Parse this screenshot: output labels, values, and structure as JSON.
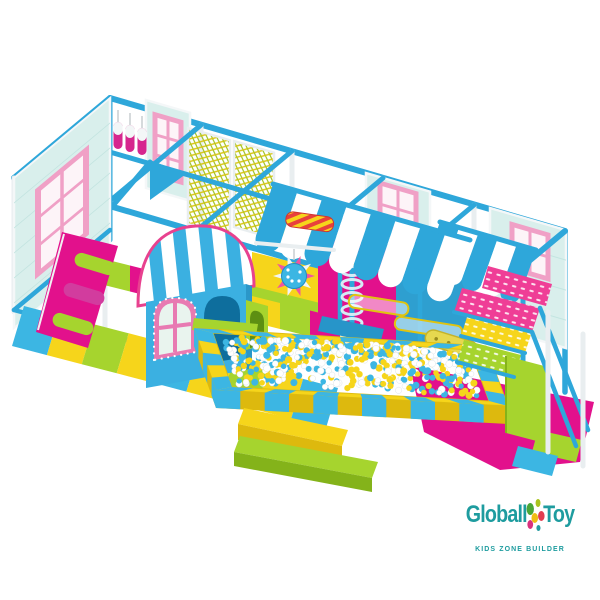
{
  "page": {
    "background": "#ffffff"
  },
  "logo": {
    "brand_first": "Globall",
    "brand_second": "Toy",
    "tagline": "KIDS ZONE BUILDER",
    "text_color": "#1e9c9f",
    "dot_colors": [
      "#49a636",
      "#a9c41f",
      "#f0bd13",
      "#e23d50",
      "#d9317e",
      "#259ba0"
    ]
  },
  "palette": {
    "pipe_blue": "#2ea7da",
    "panel_mint": "#d9efec",
    "panel_mint_line": "#c2e4e0",
    "window_pink": "#f0a0c6",
    "window_pink_deep": "#e87ab2",
    "magenta": "#e2118c",
    "yellow": "#f6d51b",
    "yellow_deep": "#ddb90e",
    "lime": "#a6d42e",
    "lime_deep": "#84b31a",
    "tent_blue": "#3bb0e1",
    "white_soft": "#f4f7f8",
    "post_white": "#e9eef0",
    "ball_blue": "#3cb6e3",
    "bag_magenta": "#d6268e",
    "logo_teal": "#1e9c9f"
  },
  "ball_pit": {
    "ball_count": 520,
    "ball_colors": [
      "#3cb6e3",
      "#f6d51b",
      "#ffffff"
    ]
  },
  "awnings": {
    "stripe_colors": [
      "#2ea7da",
      "#ffffff"
    ],
    "center_stripes": 8,
    "right_stripes": 5
  },
  "mats": {
    "floor_stripe_colors": [
      "#3cb6e3",
      "#f6d51b",
      "#a6d42e",
      "#f6d51b"
    ],
    "deck_stripe_colors": [
      "#a6d42e",
      "#e2118c",
      "#f6d51b"
    ]
  }
}
